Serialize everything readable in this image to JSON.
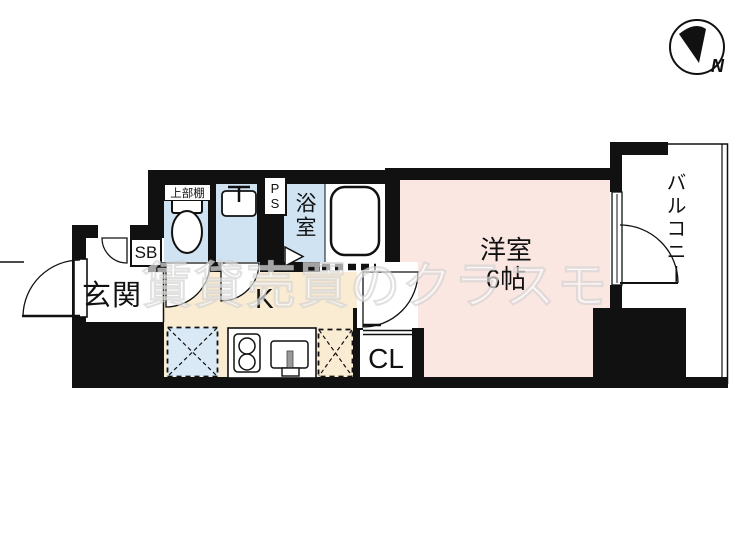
{
  "compass": {
    "label": "N"
  },
  "watermark": {
    "text": "賃貸売買のクラスモ"
  },
  "rooms": {
    "entrance": {
      "label": "玄関"
    },
    "shoe_box": {
      "label": "SB"
    },
    "upper_shelf": {
      "label": "上部棚"
    },
    "pipe_space": {
      "label": "PS"
    },
    "bathroom": {
      "label": "浴室"
    },
    "kitchen": {
      "label": "K"
    },
    "western_room": {
      "label": "洋室",
      "size": "6帖"
    },
    "closet": {
      "label": "CL"
    },
    "balcony": {
      "label": "バルコニー"
    }
  },
  "colors": {
    "wall": "#111111",
    "water_blue": "#cfe3f2",
    "room_pink": "#fbe7e2",
    "kitchen_beige": "#faecd3",
    "watermark_white": "rgba(255,255,255,0.62)"
  }
}
